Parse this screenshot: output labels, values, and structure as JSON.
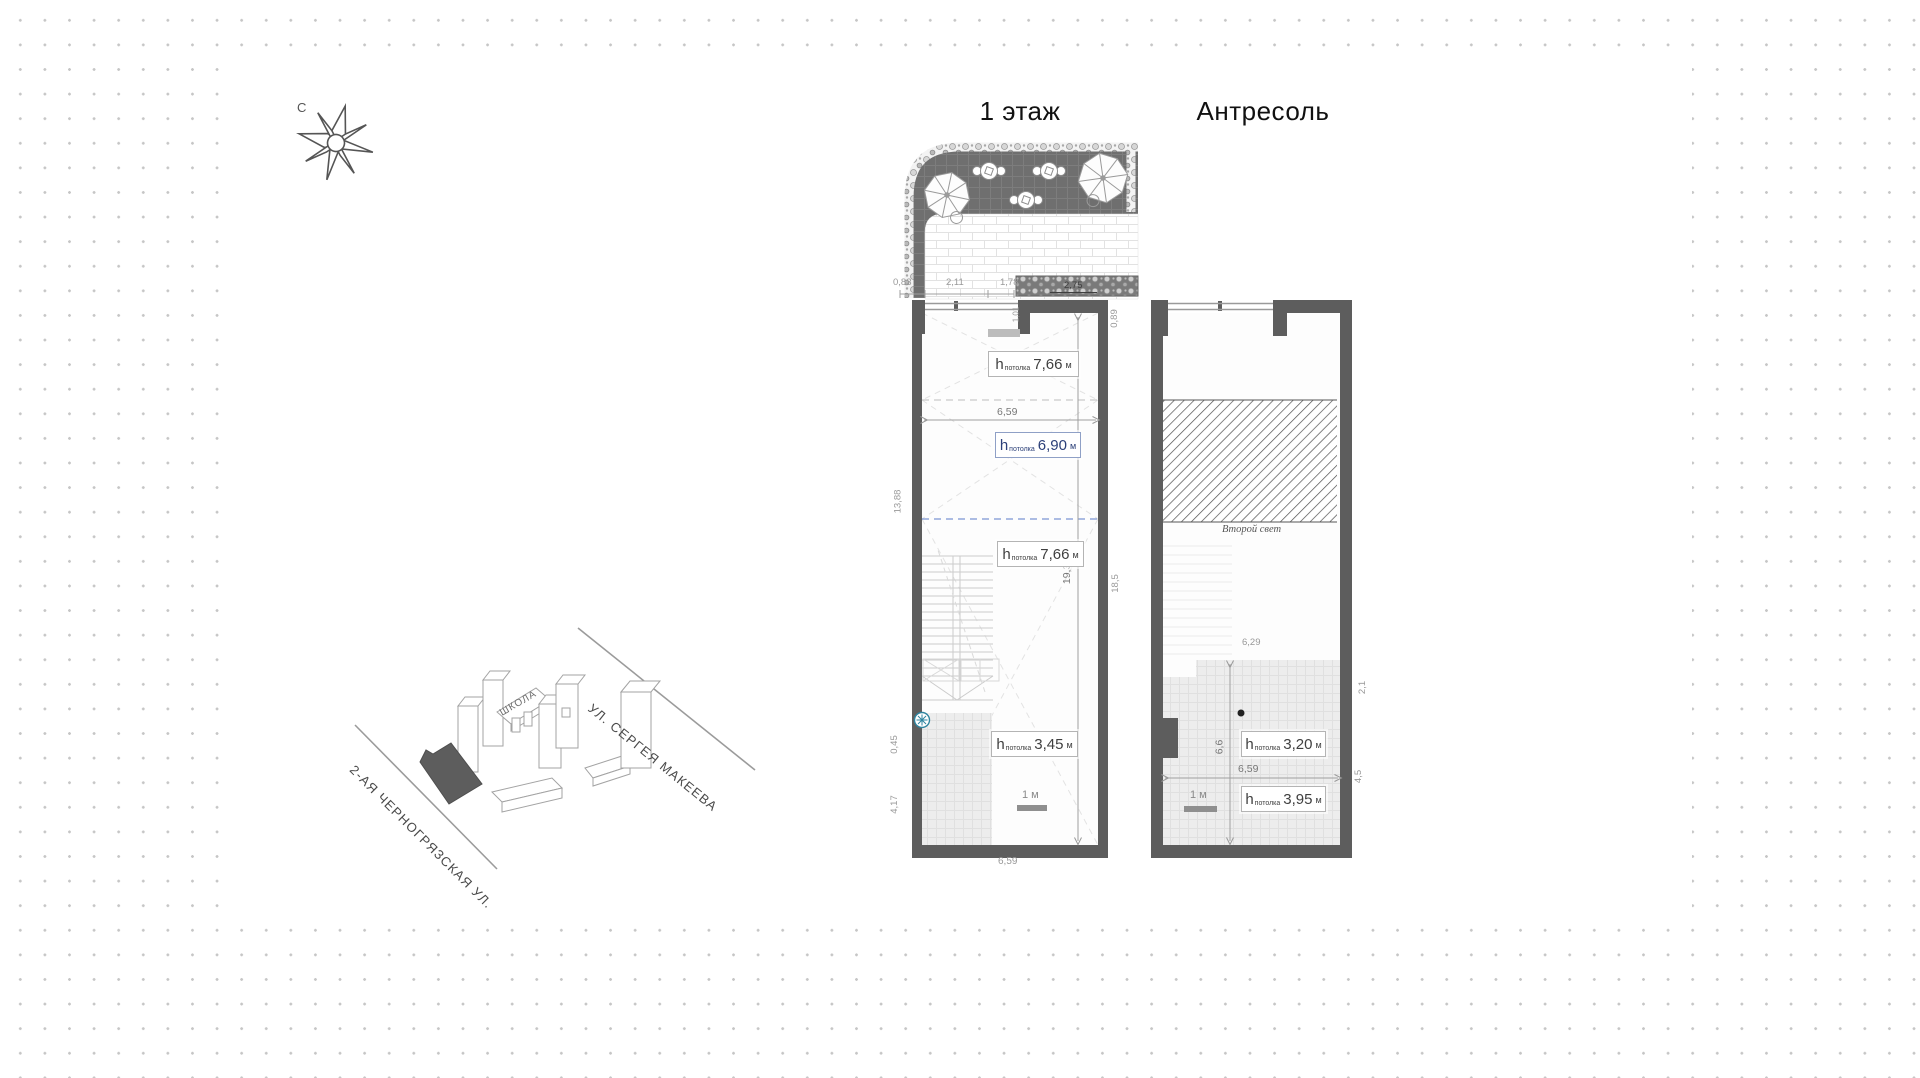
{
  "titles": {
    "floor1": "1 этаж",
    "mezzanine": "Антресоль"
  },
  "compass": {
    "north_label": "С"
  },
  "site_map": {
    "school_label": "ШКОЛА",
    "street_top": "УЛ. СЕРГЕЯ МАКЕЕВА",
    "street_bottom": "2-АЯ ЧЕРНОГРЯЗСКАЯ УЛ."
  },
  "height_label": {
    "prefix": "h",
    "sub": "потолка",
    "unit": "м"
  },
  "floor1": {
    "terrace_dims": [
      "0,83",
      "2,11",
      "1,78"
    ],
    "planter_dim": "2,75",
    "entry_dim": "1,01",
    "interior_width": "6,59",
    "bottom_width": "6,59",
    "interior_height": "19,39",
    "right_dims": [
      "0,89",
      "18,5"
    ],
    "left_dims": [
      "13,88",
      "0,45",
      "4,17"
    ],
    "ceiling_heights": [
      "7,66",
      "6,90",
      "7,66",
      "3,45"
    ],
    "scale_label": "1 м"
  },
  "mezzanine": {
    "void_label": "Второй свет",
    "upper_width": "6,29",
    "floor_depth": "6,6",
    "interior_width": "6,59",
    "right_dims": [
      "2,1",
      "4,5"
    ],
    "ceiling_heights": [
      "3,20",
      "3,95"
    ],
    "scale_label": "1 м"
  },
  "colors": {
    "wall": "#5d5d5d",
    "pavement": "#6f6f6f",
    "tile": "#ededed",
    "accent_blue": "#2c4079",
    "teal_marker": "#2f85a0",
    "dim_text": "#999999",
    "dot_grid": "#c6c6c6"
  }
}
